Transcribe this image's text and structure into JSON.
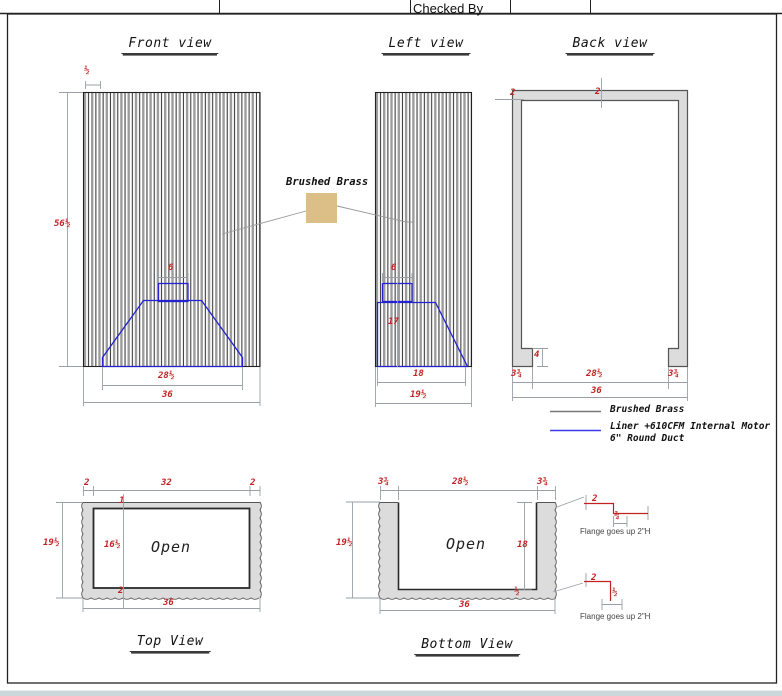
{
  "title_block": {
    "checked_by": "Checked By"
  },
  "front_view": {
    "title": "Front view",
    "dim_slat": "½",
    "dim_height": "56½",
    "dim_duct": "6",
    "dim_liner_width": "28½",
    "dim_width": "36"
  },
  "left_view": {
    "title": "Left view",
    "dim_duct": "6",
    "dim_liner_height": "17",
    "dim_liner_depth": "18",
    "dim_depth": "19½"
  },
  "back_view": {
    "title": "Back view",
    "dim_side_thickness": "2",
    "dim_top_thickness": "2",
    "dim_foot_height": "4",
    "dim_foot_left": "3¾",
    "dim_opening": "28½",
    "dim_foot_right": "3¾",
    "dim_width": "36"
  },
  "brass_callout": {
    "label": "Brushed Brass",
    "swatch_color": "#dcbf86"
  },
  "legend": {
    "brass_label": "Brushed Brass",
    "liner_label_line1": "Liner +610CFM Internal Motor",
    "liner_label_line2": "6\" Round Duct",
    "brass_color": "#777777",
    "liner_color": "#3a3aee"
  },
  "top_view": {
    "title": "Top View",
    "open_label": "Open",
    "dim_wall_left": "2",
    "dim_inner_width": "32",
    "dim_wall_right": "2",
    "dim_depth": "19½",
    "dim_inner_depth": "16½",
    "dim_front_wall": "1",
    "dim_back_wall": "2",
    "dim_width": "36"
  },
  "bottom_view": {
    "title": "Bottom View",
    "open_label": "Open",
    "dim_wall_left": "3¾",
    "dim_opening": "28½",
    "dim_wall_right": "3¾",
    "dim_depth": "19½",
    "dim_inner_depth": "18",
    "dim_floor": "½",
    "dim_width": "36"
  },
  "flange_details": [
    {
      "dim_a": "2",
      "dim_b": "¾",
      "caption": "Flange goes up 2\"H"
    },
    {
      "dim_a": "2",
      "dim_b": "½",
      "caption": "Flange goes up 2\"H"
    }
  ],
  "colors": {
    "dimension_text": "#c22222",
    "liner_line": "#2323cf",
    "frame_fill": "#dcdcdc",
    "brass_swatch": "#dcbf86",
    "bottom_strip": "#ccd7da"
  }
}
